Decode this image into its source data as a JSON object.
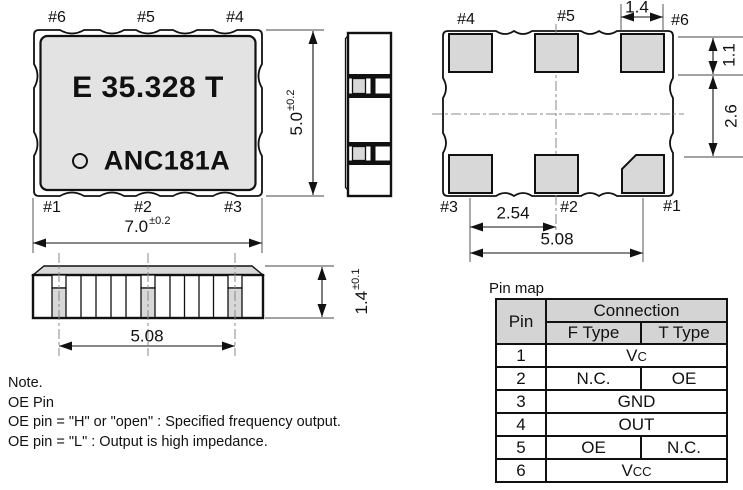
{
  "colors": {
    "ink": "#111111",
    "body_gray": "#e3e3e3",
    "pad_gray": "#d8d8d8",
    "lid_gray": "#d8d8d8",
    "header_gray": "#d4d4d4",
    "centerline": "#888888"
  },
  "front_view": {
    "marking_line1": "E 35.328 T",
    "marking_line2": "ANC181A",
    "pins_top": [
      "#6",
      "#5",
      "#4"
    ],
    "pins_bottom": [
      "#1",
      "#2",
      "#3"
    ],
    "dim_width": {
      "value": "7.0",
      "tol": "±0.2"
    },
    "dim_height": {
      "value": "5.0",
      "tol": "±0.2"
    }
  },
  "bottom_view": {
    "pins_top": [
      "#4",
      "#5",
      "#6"
    ],
    "pins_bottom": [
      "#3",
      "#2",
      "#1"
    ],
    "dim_pad_width": "1.4",
    "dim_pad_height": "1.1",
    "dim_row_gap": "2.6",
    "dim_pitch": "2.54",
    "dim_span": "5.08"
  },
  "side_view": {
    "dim_span": "5.08",
    "dim_height": {
      "value": "1.4",
      "tol": "±0.1"
    }
  },
  "note": {
    "lines": [
      "Note.",
      "OE Pin",
      "OE pin = \"H\" or \"open\" : Specified frequency output.",
      "OE pin = \"L\" : Output is high impedance."
    ]
  },
  "pin_map": {
    "title": "Pin map",
    "col_pin": "Pin",
    "col_connection": "Connection",
    "col_f": "F Type",
    "col_t": "T Type",
    "rows": [
      {
        "pin": "1",
        "merged": {
          "base": "V",
          "sub": "C"
        }
      },
      {
        "pin": "2",
        "f": "N.C.",
        "t": "OE"
      },
      {
        "pin": "3",
        "merged": {
          "base": "GND",
          "sub": ""
        }
      },
      {
        "pin": "4",
        "merged": {
          "base": "OUT",
          "sub": ""
        }
      },
      {
        "pin": "5",
        "f": "OE",
        "t": "N.C."
      },
      {
        "pin": "6",
        "merged": {
          "base": "V",
          "sub": "CC"
        }
      }
    ]
  }
}
